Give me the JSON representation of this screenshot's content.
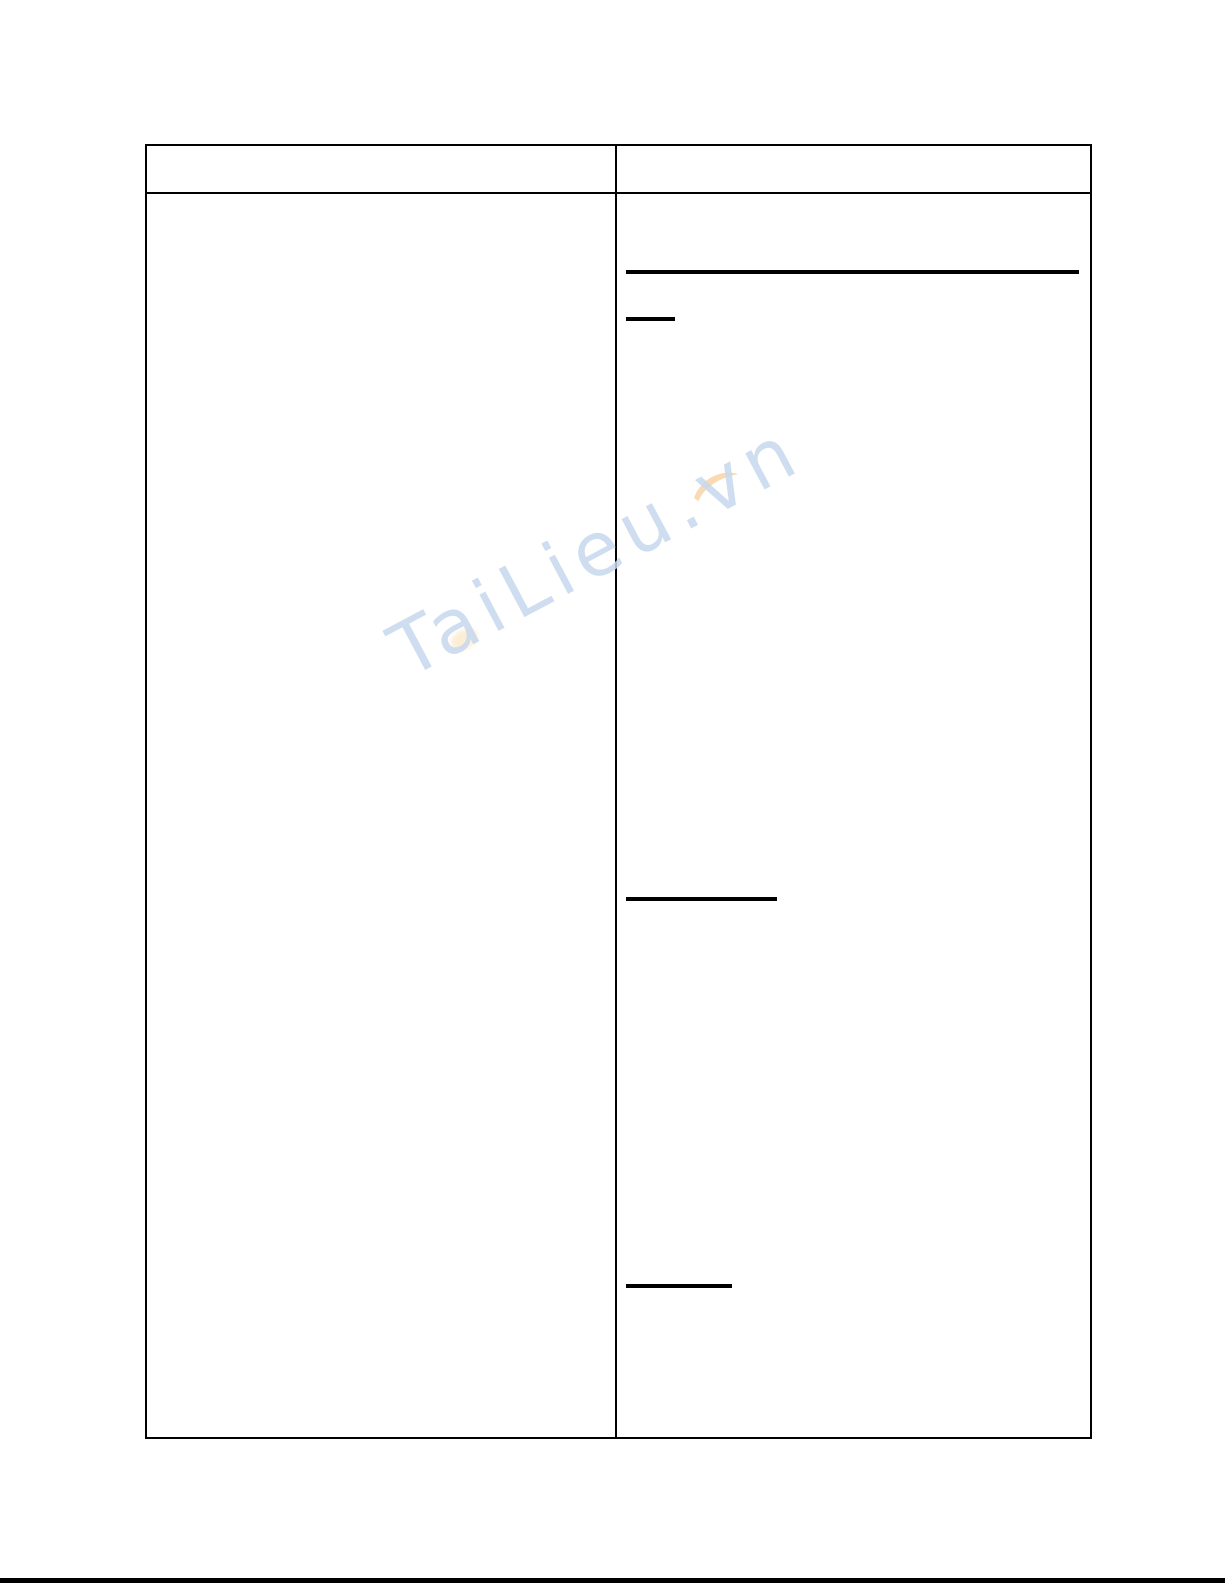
{
  "page": {
    "background_color": "#ffffff",
    "table_border_color": "#000000",
    "bottom_bar_color": "#000000"
  },
  "watermark": {
    "text": "TaiLieu.vn",
    "text_color": "#c7d8ef",
    "swoosh_color": "#f6bd77"
  },
  "table": {
    "header": {
      "left_cell": "",
      "right_cell": ""
    },
    "body": {
      "left_cell": "",
      "right_cell": ""
    }
  }
}
